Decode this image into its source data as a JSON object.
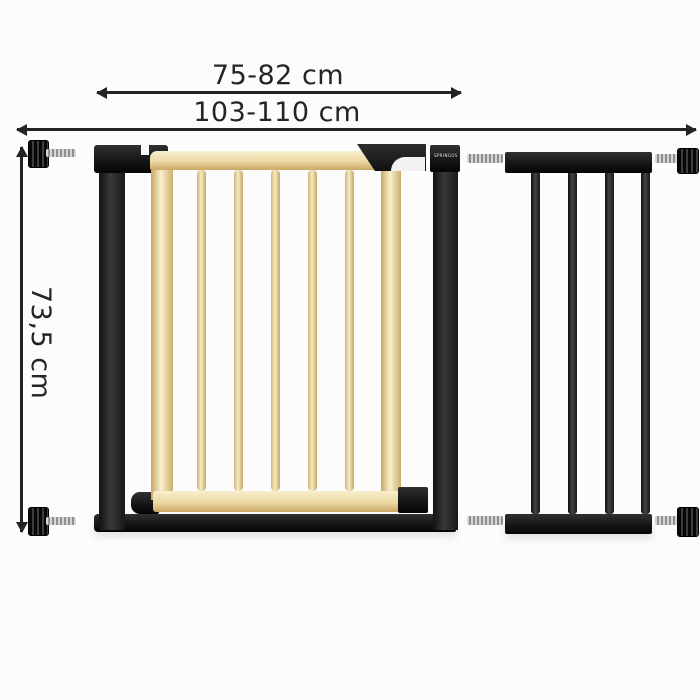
{
  "meta": {
    "background": "#fcfcfc",
    "description": "Safety gate with extension, dimension diagram"
  },
  "dimensions": {
    "door_width": "75-82 cm",
    "total_width": "103-110 cm",
    "height": "73,5 cm"
  },
  "brand": {
    "logo_text": "SPRINGOS"
  },
  "colors": {
    "frame_black": "#1e1e1e",
    "wood": "#ecd9a4",
    "wood_dark": "#c9a865",
    "wood_light": "#f8efcd",
    "metal_silver": "#bdbdbd",
    "annotation": "#242424",
    "latch_white": "#f1f1f1",
    "background": "#fcfcfc"
  },
  "gate": {
    "wooden_bar_count": 5
  },
  "extension": {
    "bar_count": 4
  }
}
